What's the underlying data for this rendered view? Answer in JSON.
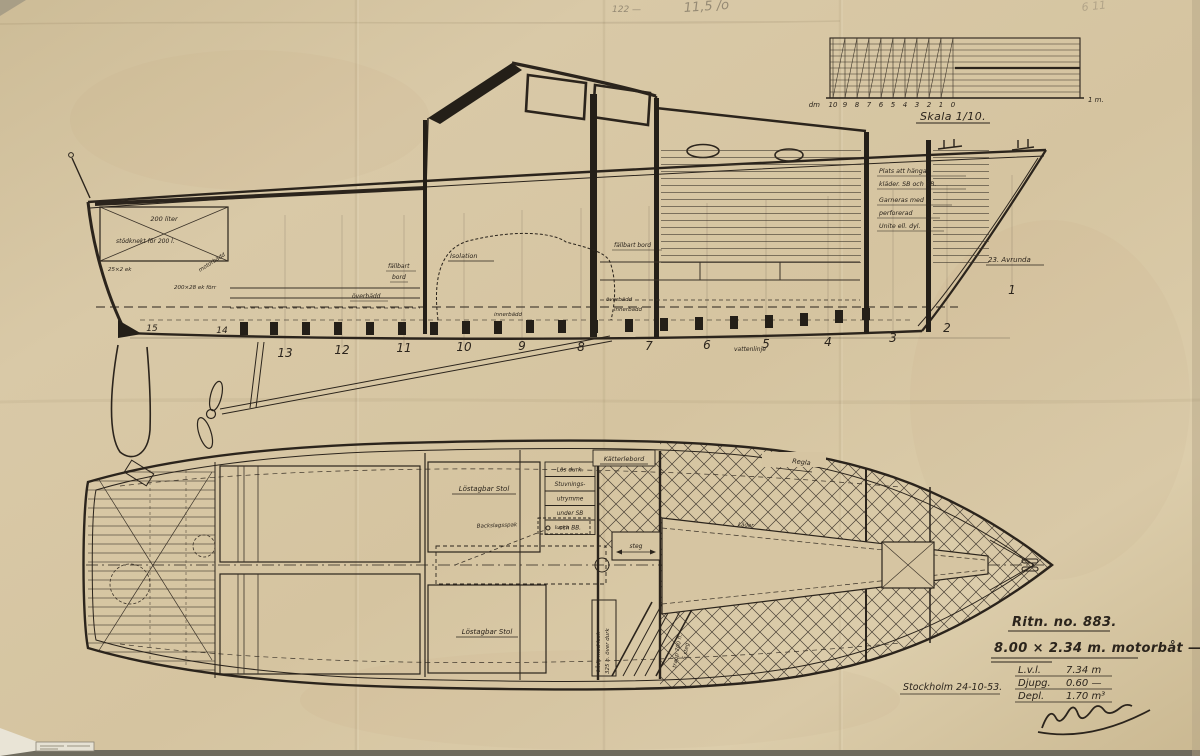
{
  "colors": {
    "paper": "#d6c5a2",
    "ink": "#2b241c",
    "pencil": "#958a74"
  },
  "pencil_notes": {
    "left": "122 —",
    "center": "11,5 /o",
    "right": "6 11"
  },
  "scale_bar": {
    "left_unit": "dm",
    "right_unit": "1 m.",
    "caption": "Skala 1/10.",
    "ticks": [
      "10",
      "9",
      "8",
      "7",
      "6",
      "5",
      "4",
      "3",
      "2",
      "1",
      "0"
    ]
  },
  "side_view": {
    "frames": [
      "15",
      "14",
      "13",
      "12",
      "11",
      "10",
      "9",
      "8",
      "7",
      "6",
      "5",
      "4",
      "3",
      "2",
      "1"
    ],
    "labels": {
      "tank": "200 liter",
      "tank_support": "stödknekt för 200 l.",
      "timber1": "25×2 ek",
      "timber2": "200×28 ek förr",
      "motor_bed": "motorbädd",
      "isolation": "Isolation",
      "table_cockpit": [
        "fällbart",
        "bord"
      ],
      "table_saloon": "fällbart bord",
      "wardrobe": [
        "Plats att hänga",
        "kläder. SB och BB.",
        "Garneras med",
        "perforerad",
        "Unite ell. dyl."
      ],
      "berth_upper": "överbädd",
      "berth_inner": "innerbädd",
      "stem_note": "23. Avrunda",
      "waterline": "vattenlinje"
    }
  },
  "plan_view": {
    "labels": {
      "seat_fwd": "Löstagbar Stol",
      "seat_aft": "Löstagbar Stol",
      "storage": [
        "Lös durk.",
        "Stuvnings-",
        "utrymme",
        "under SB",
        "och BB."
      ],
      "table": "Kätterlebord",
      "gear_lever": "Backslagsspak",
      "hatch": "lucka",
      "step": "steg",
      "deck_batten": "Regla",
      "upholstery": "Läder",
      "box": [
        "Låda med lock",
        "325 h. över durk"
      ],
      "stairs": [
        "trapp 700 h.",
        "5 steg"
      ]
    }
  },
  "title_block": {
    "ritn_no": "Ritn. no. 883.",
    "boat": "8.00 × 2.34 m. motorbåt —",
    "specs": [
      {
        "label": "L.v.l.",
        "value": "7.34 m"
      },
      {
        "label": "Djupg.",
        "value": "0.60 —"
      },
      {
        "label": "Depl.",
        "value": "1.70 m³"
      }
    ],
    "place_date": "Stockholm 24-10-53."
  }
}
